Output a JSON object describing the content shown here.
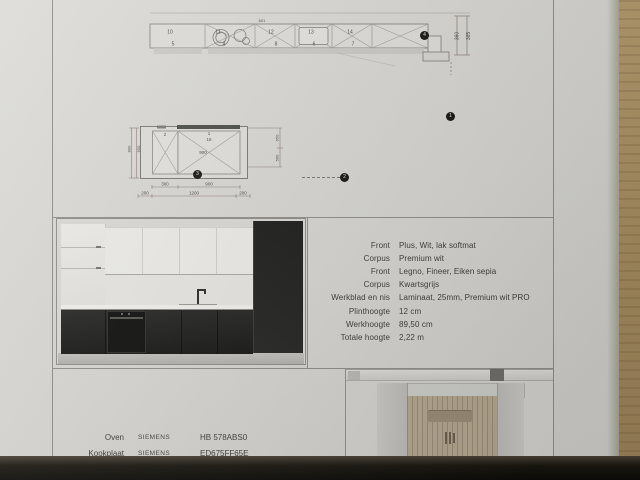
{
  "document": {
    "plan_top": {
      "unit_numbers_top": [
        "10",
        "11",
        "12",
        "13",
        "14"
      ],
      "unit_numbers_bottom": [
        "5",
        "4",
        "8",
        "6",
        "7"
      ],
      "note": "601",
      "dim_right_1": "360",
      "dim_right_2": "365"
    },
    "island_plan": {
      "labels": {
        "small_unit": "2",
        "large_unit": "1",
        "large_unit_sub": "16",
        "inner_width": "900"
      },
      "dims_bottom_1": [
        "300",
        "900"
      ],
      "dims_bottom_2": [
        "200",
        "1200",
        "200"
      ],
      "dims_left": [
        "800",
        "650"
      ],
      "dims_right": [
        "650",
        "560"
      ]
    },
    "markers": {
      "m1": "1",
      "m2": "2",
      "m3": "3",
      "m4": "4"
    },
    "spec_table": {
      "rows": [
        {
          "label": "Front",
          "value": "Plus, Wit, lak softmat"
        },
        {
          "label": "Corpus",
          "value": "Premium wit"
        },
        {
          "label": "Front",
          "value": "Legno, Fineer, Eiken sepia"
        },
        {
          "label": "Corpus",
          "value": "Kwartsgrijs"
        },
        {
          "label": "Werkblad en nis",
          "value": "Laminaat, 25mm, Premium wit PRO"
        },
        {
          "label": "Plinthoogte",
          "value": "12 cm"
        },
        {
          "label": "Werkhoogte",
          "value": "89,50 cm"
        },
        {
          "label": "Totale hoogte",
          "value": "2,22 m"
        }
      ]
    },
    "appliance_table": {
      "rows": [
        {
          "label": "Oven",
          "brand": "SIEMENS",
          "model": "HB 578ABS0"
        },
        {
          "label": "Kookplaat",
          "brand": "SIEMENS",
          "model": "ED675FF65E"
        }
      ]
    },
    "colors": {
      "paper": "#d6d5d1",
      "wood": "#9a8157",
      "dark_base": "#1b1b19"
    }
  }
}
